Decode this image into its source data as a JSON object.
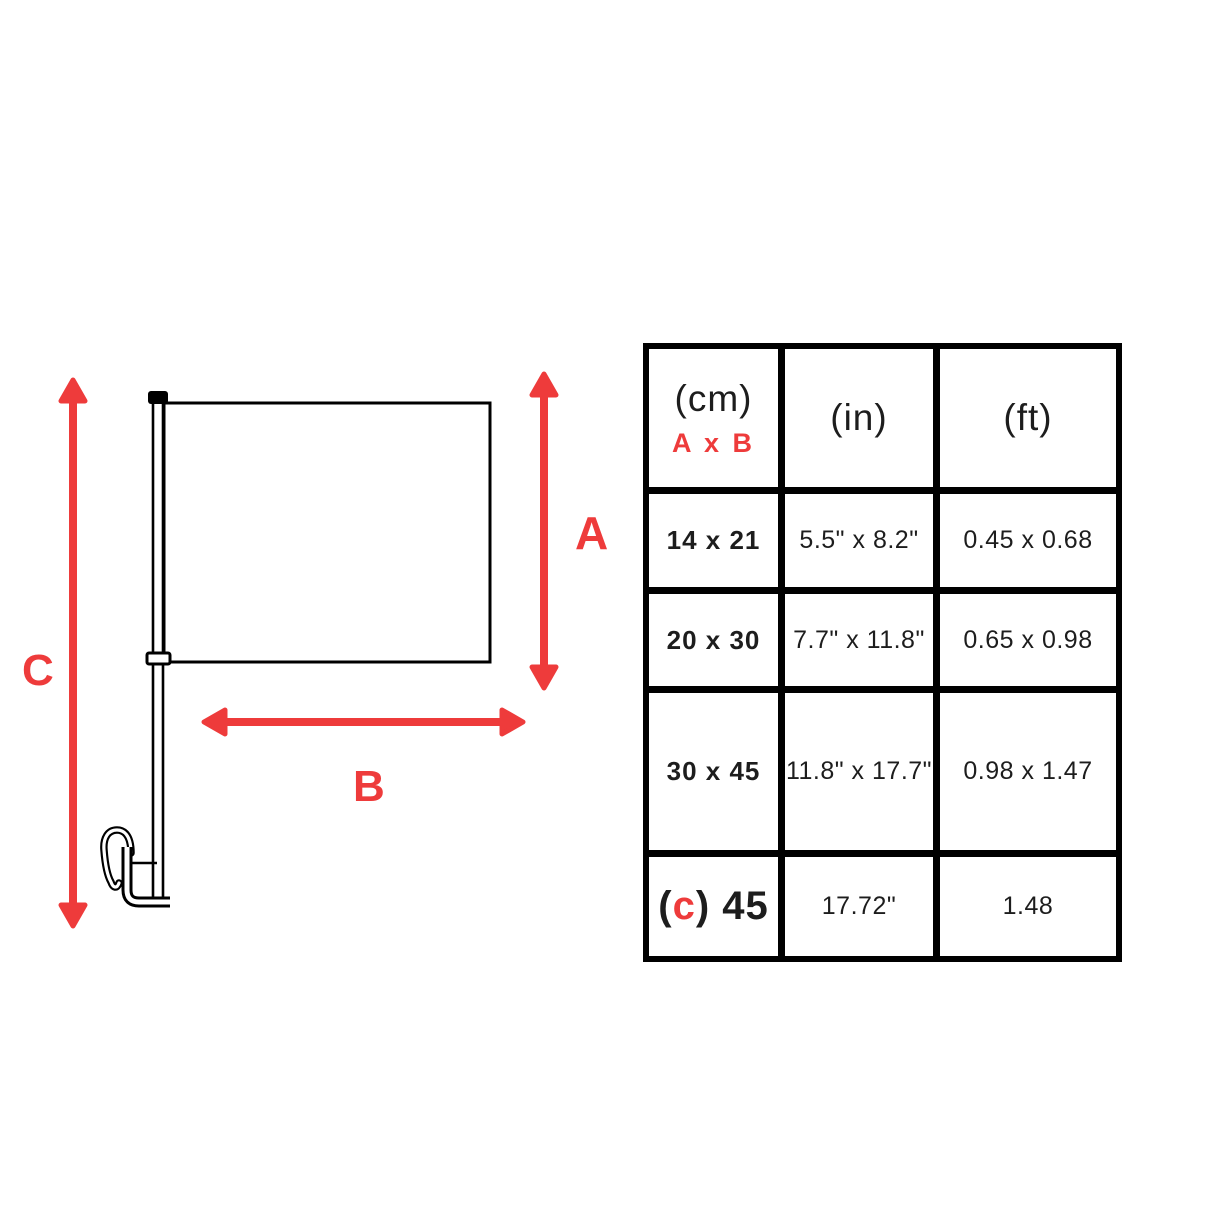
{
  "colors": {
    "accent_red": "#EE3B3B",
    "line_black": "#000000",
    "text_dark": "#1d1d1d"
  },
  "diagram": {
    "label_a": "A",
    "label_b": "B",
    "label_c": "C"
  },
  "table": {
    "header": {
      "cm_unit": "(cm)",
      "cm_axes": "A x B",
      "in_unit": "(in)",
      "ft_unit": "(ft)"
    },
    "rows": [
      {
        "cm": "14 x 21",
        "inches": "5.5\" x 8.2\"",
        "feet": "0.45 x 0.68"
      },
      {
        "cm": "20 x 30",
        "inches": "7.7\" x 11.8\"",
        "feet": "0.65 x 0.98"
      },
      {
        "cm": "30 x 45",
        "inches": "11.8\" x 17.7\"",
        "feet": "0.98 x 1.47"
      },
      {
        "cm_open": "(",
        "cm_c": "c",
        "cm_close": ") 45",
        "inches": "17.72\"",
        "feet": "1.48"
      }
    ]
  }
}
